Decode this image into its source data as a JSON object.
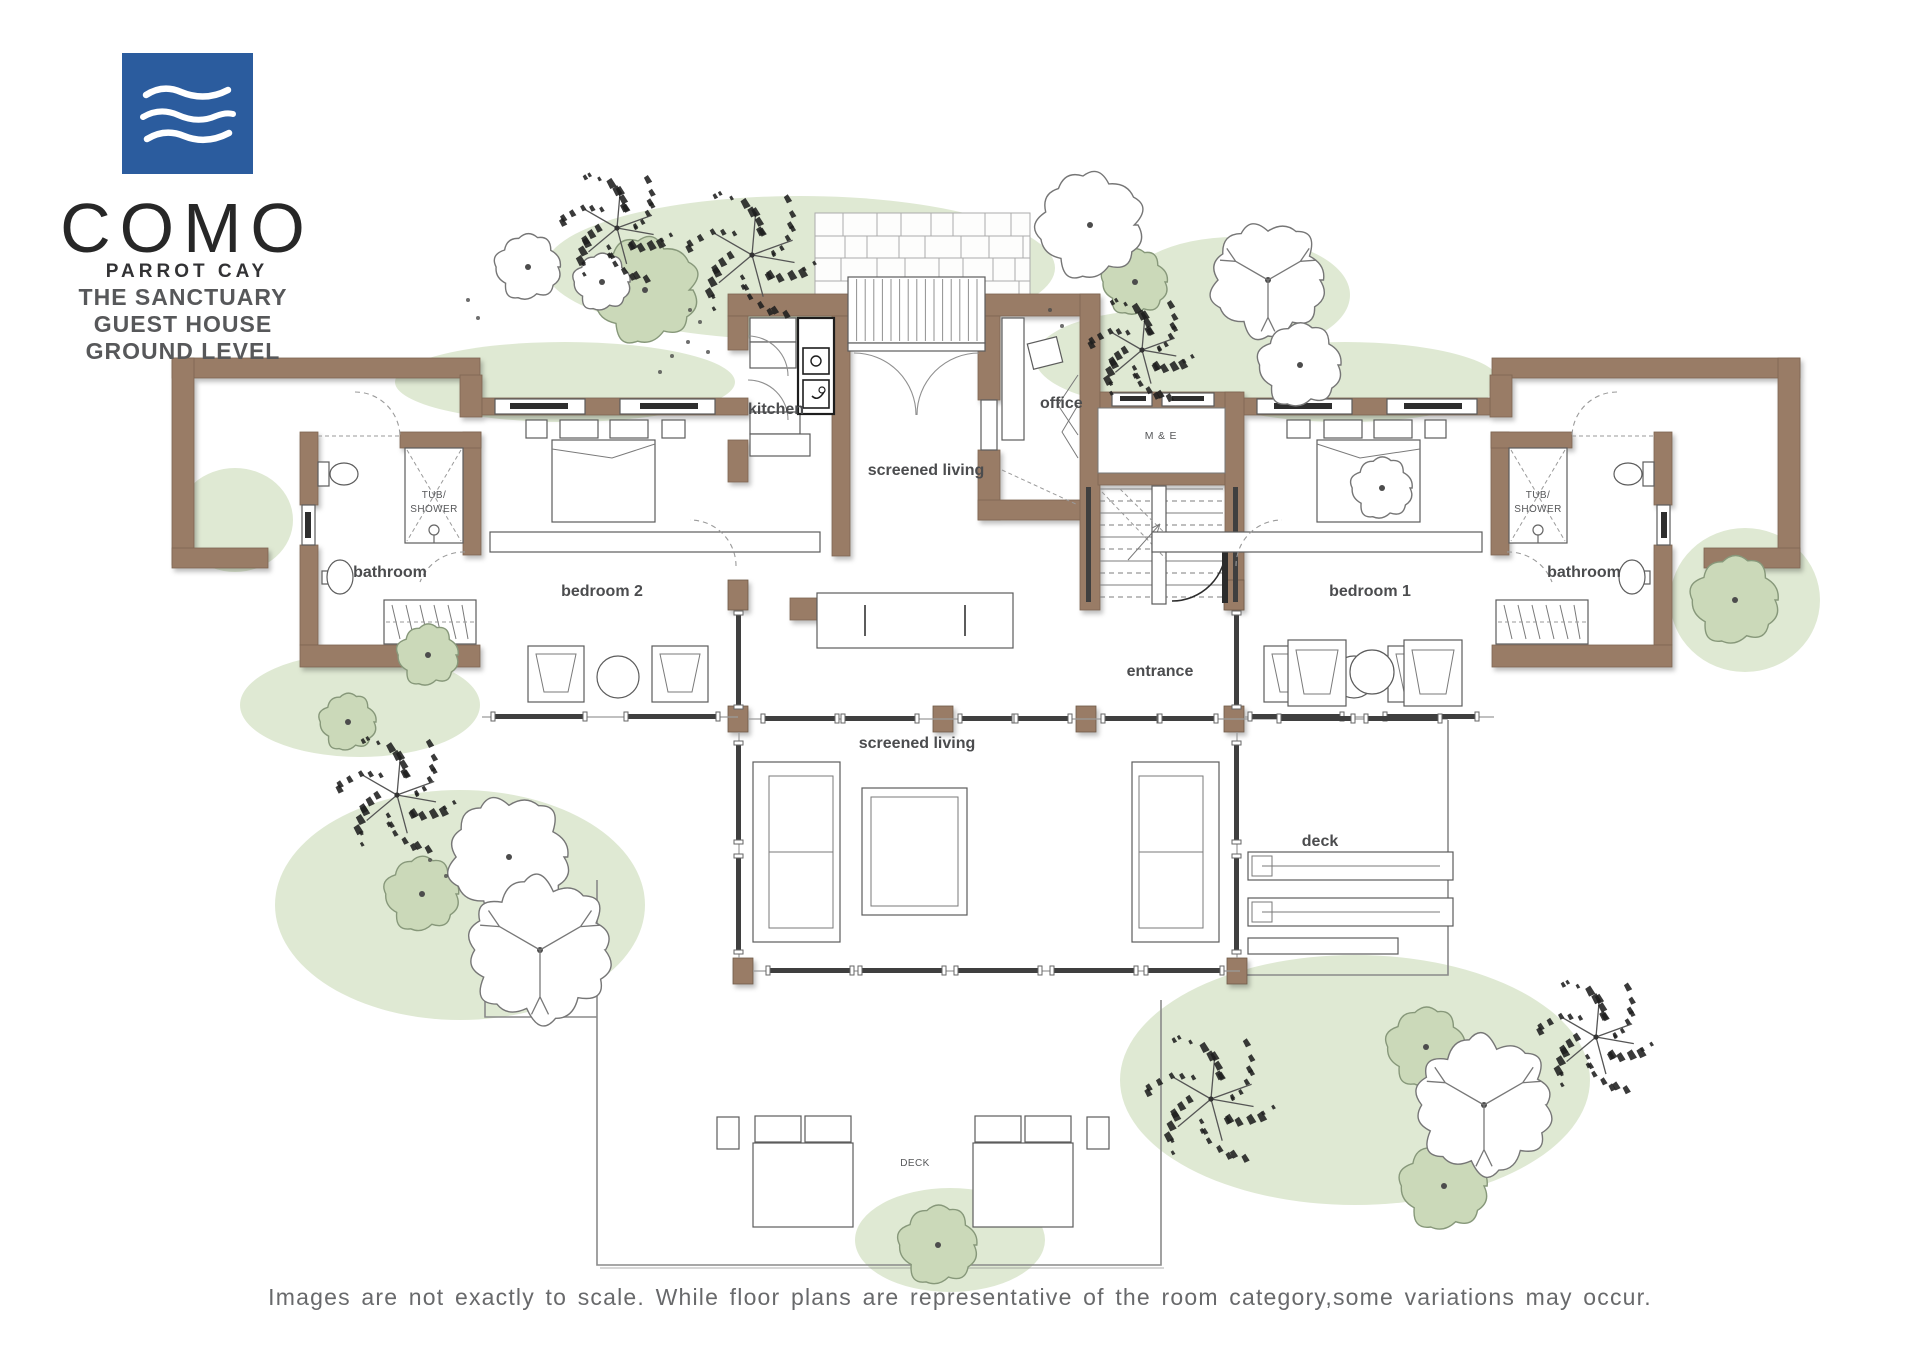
{
  "logo": {
    "brand": "COMO",
    "sub": "PARROT CAY"
  },
  "header": {
    "line1": "THE SANCTUARY",
    "line2": "GUEST HOUSE",
    "line3": "GROUND LEVEL"
  },
  "rooms": {
    "kitchen": "kitchen",
    "office": "office",
    "screened_living_upper": "screened living",
    "me": "M & E",
    "bedroom2": "bedroom 2",
    "bedroom1": "bedroom 1",
    "bathroom_left": "bathroom",
    "bathroom_right": "bathroom",
    "tub_shower_line1": "TUB/",
    "tub_shower_line2": "SHOWER",
    "entrance": "entrance",
    "screened_living_lower": "screened living",
    "deck": "deck",
    "deck_lower": "DECK"
  },
  "footer": {
    "caption": "Images are not exactly to scale. While floor plans are representative of the room category,some variations may occur."
  },
  "colors": {
    "wall": "#997b66",
    "logo_blue": "#2b5c9e",
    "label": "#4b4c4e",
    "tree_green": "#cbd9b9",
    "wash_green": "#dfe9d3"
  }
}
